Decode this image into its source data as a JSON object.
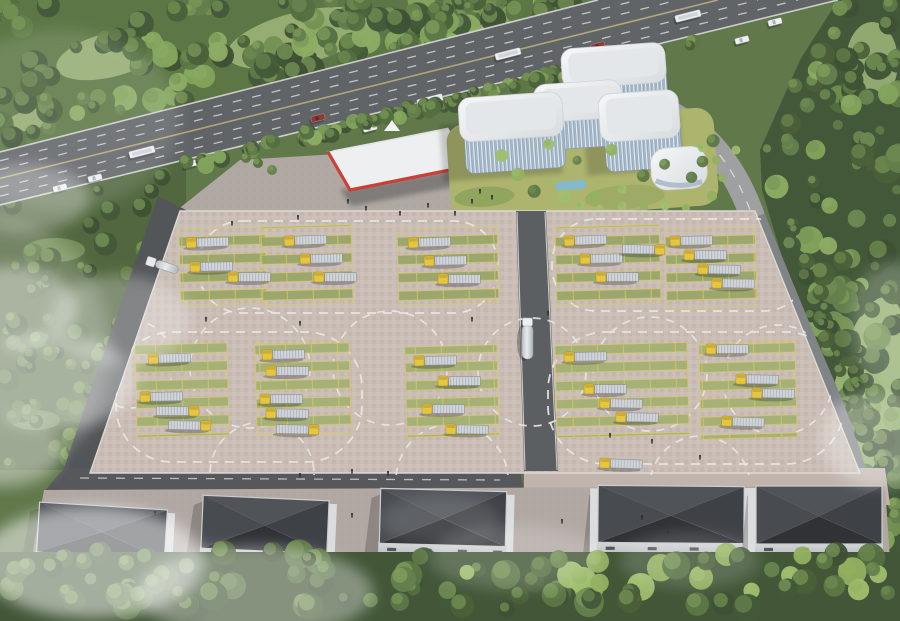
{
  "scene": {
    "description": "Aerial rendering of a truck logistics and inspection depot: highway with traffic at top, modern white office complex, red-trim canopy, large truck parking lot with dashed test-loop lane markings, green parking stalls, five dark-roof warehouses at bottom, forests and drifting fog",
    "palette": {
      "forest_dark": "#3a5130",
      "forest_mid": "#55713d",
      "forest_light": "#6f8c4c",
      "meadow": "#9cb474",
      "underlay_green": "#5a7243",
      "highway_asphalt": "#595d60",
      "road_asphalt": "#4b4e51",
      "road_concrete": "#96989a",
      "lot_pavement": "#c8bbb3",
      "lane_marking": "#e9e7e3",
      "stall_green": "#94a263",
      "stall_yellow": "#d9c75d",
      "truck_cab_yellow": "#e5c437",
      "truck_trailer_silver": "#c9ced4",
      "building_white": "#eef1f3",
      "building_glass": "#8ea6ba",
      "canopy_white": "#eff0f1",
      "canopy_red": "#c8372e",
      "warehouse_roof": "#33363b",
      "warehouse_wall": "#c7c9cb",
      "water_blue": "#7fb6c9",
      "fog_white": "#ffffff"
    },
    "counts": {
      "parked_trucks": 38,
      "moving_trucks": 3,
      "warehouses": 5,
      "parking_blocks": 10,
      "highway_vehicles": 16
    },
    "highway": {
      "edge_top": [
        [
          0,
          152
        ],
        [
          598,
          0
        ]
      ],
      "edge_bottom": [
        [
          0,
          205
        ],
        [
          838,
          0
        ]
      ],
      "vehicles": [
        [
          95,
          178,
          "car"
        ],
        [
          142,
          152,
          "bus"
        ],
        [
          190,
          164,
          "car"
        ],
        [
          252,
          146,
          "car"
        ],
        [
          318,
          118,
          "car_red"
        ],
        [
          370,
          128,
          "car"
        ],
        [
          430,
          100,
          "bus"
        ],
        [
          474,
          110,
          "car"
        ],
        [
          508,
          54,
          "bus"
        ],
        [
          564,
          86,
          "car"
        ],
        [
          598,
          46,
          "car_red"
        ],
        [
          642,
          70,
          "car"
        ],
        [
          688,
          16,
          "bus"
        ],
        [
          742,
          40,
          "car"
        ],
        [
          60,
          188,
          "car"
        ],
        [
          775,
          22,
          "car"
        ]
      ]
    },
    "lot": {
      "inner": [
        [
          180,
          211
        ],
        [
          755,
          211
        ],
        [
          860,
          473
        ],
        [
          90,
          473
        ]
      ],
      "central_road": [
        [
          516,
          211
        ],
        [
          546,
          211
        ],
        [
          558,
          471
        ],
        [
          524,
          471
        ]
      ],
      "loops": [
        [
          198,
          221,
          300,
          92,
          44
        ],
        [
          552,
          219,
          256,
          92,
          44
        ],
        [
          116,
          332,
          246,
          130,
          56
        ],
        [
          548,
          332,
          296,
          132,
          58
        ]
      ],
      "circles": [
        [
          250,
          368,
          60
        ],
        [
          390,
          368,
          57
        ],
        [
          532,
          372,
          54
        ],
        [
          650,
          374,
          57
        ],
        [
          778,
          380,
          55
        ],
        [
          130,
          364,
          44
        ],
        [
          262,
          474,
          52
        ],
        [
          452,
          480,
          56
        ],
        [
          700,
          486,
          50
        ]
      ],
      "blocks": [
        [
          180,
          228,
          86,
          76,
          "A"
        ],
        [
          262,
          226,
          90,
          78,
          "A"
        ],
        [
          398,
          228,
          100,
          76,
          "A"
        ],
        [
          556,
          226,
          104,
          78,
          "A"
        ],
        [
          666,
          228,
          90,
          80,
          "A"
        ],
        [
          136,
          344,
          92,
          92,
          "B"
        ],
        [
          256,
          342,
          94,
          92,
          "B"
        ],
        [
          406,
          346,
          92,
          90,
          "B"
        ],
        [
          556,
          344,
          132,
          92,
          "B"
        ],
        [
          700,
          342,
          96,
          96,
          "B"
        ]
      ],
      "trucks": [
        [
          186,
          238,
          "L",
          -2
        ],
        [
          190,
          262,
          "L",
          -1
        ],
        [
          228,
          272,
          "L",
          0
        ],
        [
          284,
          236,
          "L",
          -2
        ],
        [
          300,
          254,
          "L",
          -1
        ],
        [
          314,
          272,
          "L",
          0
        ],
        [
          408,
          238,
          "L",
          -2
        ],
        [
          424,
          256,
          "L",
          -1
        ],
        [
          438,
          274,
          "L",
          0
        ],
        [
          564,
          236,
          "L",
          -2
        ],
        [
          580,
          254,
          "L",
          -1
        ],
        [
          596,
          272,
          "L",
          0
        ],
        [
          622,
          244,
          "R",
          1
        ],
        [
          670,
          236,
          "L",
          -1
        ],
        [
          684,
          250,
          "L",
          0
        ],
        [
          698,
          264,
          "L",
          1
        ],
        [
          712,
          278,
          "L",
          1
        ],
        [
          148,
          354,
          "L",
          -2
        ],
        [
          140,
          392,
          "L",
          -1
        ],
        [
          156,
          406,
          "R",
          0
        ],
        [
          168,
          420,
          "R",
          1
        ],
        [
          262,
          350,
          "L",
          -1
        ],
        [
          266,
          366,
          "L",
          0
        ],
        [
          260,
          394,
          "L",
          0
        ],
        [
          266,
          408,
          "L",
          1
        ],
        [
          276,
          424,
          "R",
          1
        ],
        [
          414,
          356,
          "L",
          -1
        ],
        [
          438,
          376,
          "L",
          0
        ],
        [
          422,
          404,
          "L",
          0
        ],
        [
          446,
          424,
          "L",
          1
        ],
        [
          564,
          352,
          "L",
          -1
        ],
        [
          584,
          384,
          "L",
          0
        ],
        [
          600,
          398,
          "L",
          1
        ],
        [
          616,
          412,
          "L",
          1
        ],
        [
          706,
          344,
          "L",
          0
        ],
        [
          736,
          374,
          "L",
          1
        ],
        [
          752,
          388,
          "L",
          1
        ],
        [
          722,
          416,
          "L",
          2
        ]
      ],
      "movers": {
        "central_tanker": [
          522,
          318
        ],
        "exit_truck": [
          600,
          458,
          "L",
          2
        ],
        "service_tanker": [
          148,
          256,
          18
        ]
      }
    },
    "warehouses": [
      [
        38,
        506,
        128,
        50,
        3.5,
        "R",
        15
      ],
      [
        202,
        498,
        126,
        53,
        2.5,
        "R",
        14
      ],
      [
        380,
        490,
        126,
        55,
        1.5,
        "R",
        14
      ],
      [
        598,
        486,
        146,
        57,
        0.5,
        "L",
        14
      ],
      [
        756,
        486,
        126,
        58,
        0,
        "L",
        13
      ]
    ],
    "people": [
      [
        348,
        200
      ],
      [
        366,
        207
      ],
      [
        400,
        212
      ],
      [
        428,
        204
      ],
      [
        455,
        212
      ],
      [
        472,
        200
      ],
      [
        298,
        216
      ],
      [
        232,
        222
      ],
      [
        480,
        190
      ],
      [
        492,
        196
      ],
      [
        206,
        318
      ],
      [
        300,
        322
      ],
      [
        472,
        318
      ],
      [
        548,
        312
      ],
      [
        610,
        434
      ],
      [
        652,
        440
      ],
      [
        700,
        456
      ],
      [
        352,
        470
      ],
      [
        388,
        472
      ],
      [
        300,
        474
      ],
      [
        155,
        512
      ],
      [
        352,
        514
      ],
      [
        562,
        520
      ],
      [
        642,
        516
      ],
      [
        668,
        532
      ]
    ],
    "fog": [
      [
        14,
        308,
        64,
        42,
        0.4
      ],
      [
        52,
        382,
        84,
        48,
        0.38
      ],
      [
        6,
        452,
        56,
        36,
        0.3
      ],
      [
        92,
        562,
        112,
        56,
        0.52
      ],
      [
        255,
        592,
        118,
        46,
        0.36
      ],
      [
        515,
        558,
        85,
        32,
        0.18
      ],
      [
        878,
        438,
        58,
        48,
        0.32
      ],
      [
        893,
        326,
        42,
        64,
        0.22
      ],
      [
        26,
        198,
        64,
        34,
        0.3
      ],
      [
        120,
        320,
        70,
        45,
        0.28
      ],
      [
        0,
        350,
        110,
        130,
        0.2
      ],
      [
        60,
        120,
        120,
        90,
        0.12
      ],
      [
        440,
        520,
        60,
        25,
        0.12
      ],
      [
        690,
        560,
        70,
        28,
        0.15
      ]
    ]
  }
}
